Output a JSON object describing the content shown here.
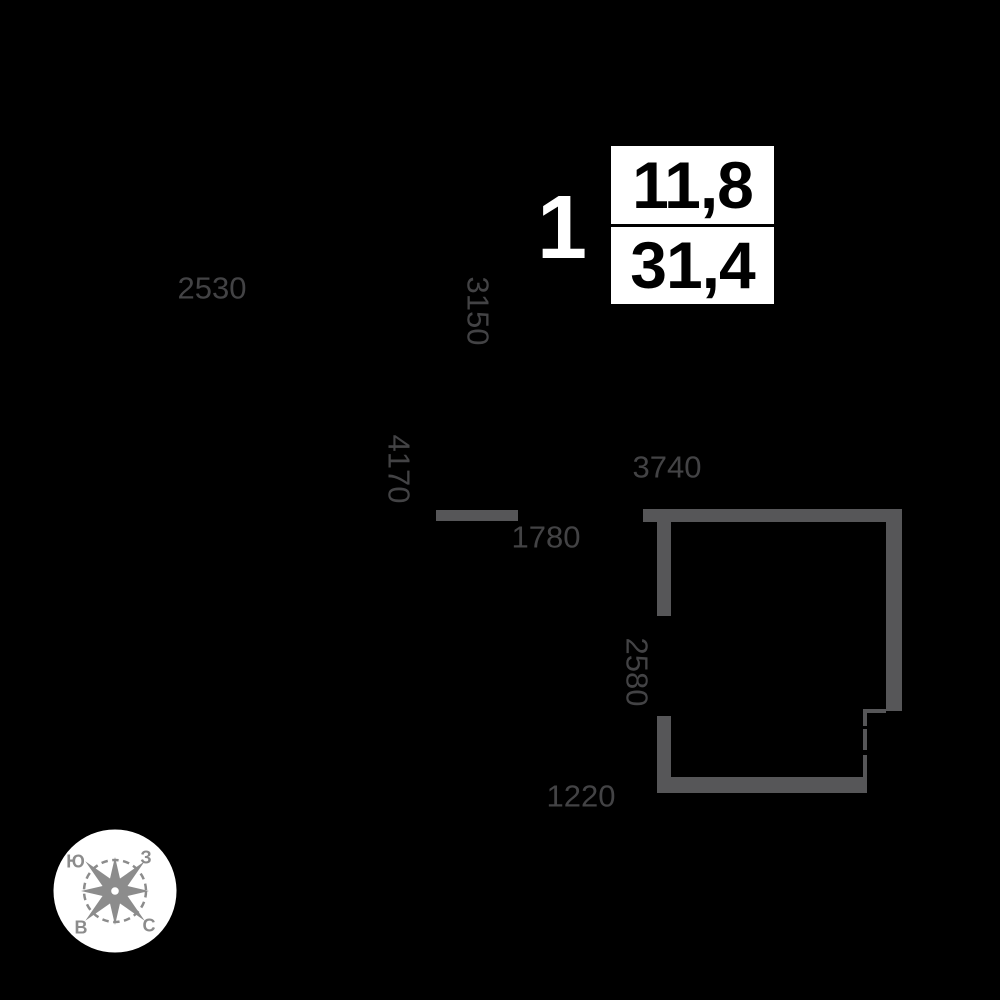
{
  "unit": {
    "rooms_label": "1",
    "living_area": "11,8",
    "total_area": "31,4"
  },
  "dimensions": {
    "top_width": "2530",
    "top_height": "3150",
    "mid_height": "4170",
    "room_width": "3740",
    "opening_width": "1780",
    "room_height": "2580",
    "bottom_width": "1220"
  },
  "compass": {
    "south_label": "Ю",
    "west_label": "З",
    "east_label": "В",
    "north_label": "С"
  },
  "colors": {
    "background": "#000000",
    "wall": "#565658",
    "dimension_text": "#434345",
    "rooms_text": "#ffffff",
    "info_box_bg": "#ffffff",
    "info_text": "#000000",
    "compass_bg": "#ffffff",
    "compass_glyph": "#8c8c8c"
  }
}
